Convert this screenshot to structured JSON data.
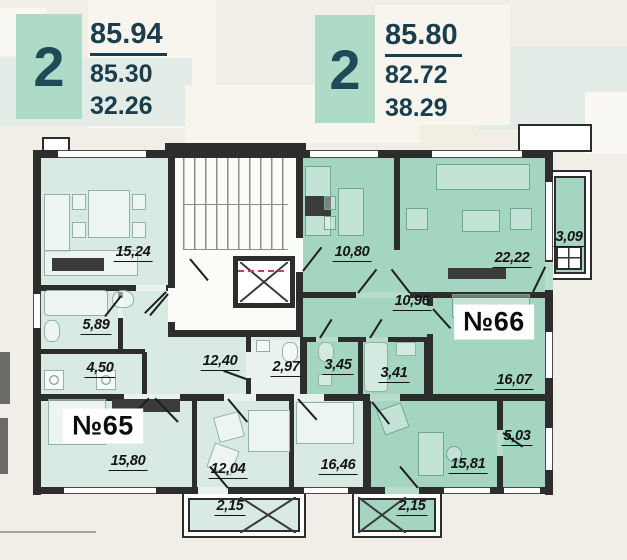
{
  "cards": [
    {
      "rooms_count": "2",
      "area_total": "85.94",
      "area_living": "85.30",
      "area_kitchen": "32.26"
    },
    {
      "rooms_count": "2",
      "area_total": "85.80",
      "area_living": "82.72",
      "area_kitchen": "38.29"
    }
  ],
  "apartments": [
    {
      "number": "№65",
      "fill_color": "#d9eae3",
      "rooms": [
        {
          "name": "kitchen-living",
          "area": "15,24"
        },
        {
          "name": "bathroom",
          "area": "5,89"
        },
        {
          "name": "hallway",
          "area": "4,50"
        },
        {
          "name": "corridor",
          "area": "12,40"
        },
        {
          "name": "wc",
          "area": "2,97"
        },
        {
          "name": "bedroom",
          "area": "15,80"
        },
        {
          "name": "room",
          "area": "12,04"
        },
        {
          "name": "room",
          "area": "16,46"
        },
        {
          "name": "balcony",
          "area": "2,15"
        }
      ]
    },
    {
      "number": "№66",
      "fill_color": "#a4d5c1",
      "rooms": [
        {
          "name": "kitchen",
          "area": "10,80"
        },
        {
          "name": "living-room",
          "area": "22,22"
        },
        {
          "name": "balcony",
          "area": "3,09"
        },
        {
          "name": "hallway",
          "area": "10,96"
        },
        {
          "name": "wc",
          "area": "3,45"
        },
        {
          "name": "bathroom",
          "area": "3,41"
        },
        {
          "name": "bedroom",
          "area": "16,07"
        },
        {
          "name": "loggia",
          "area": "5,03"
        },
        {
          "name": "room",
          "area": "15,81"
        },
        {
          "name": "balcony",
          "area": "2,15"
        }
      ]
    }
  ],
  "colors": {
    "wall": "#2d2d2d",
    "accent_teal": "#aedbc8",
    "number_text": "#1a3e4d",
    "apt65_fill": "#d9eae3",
    "apt66_fill": "#a4d5c1"
  }
}
